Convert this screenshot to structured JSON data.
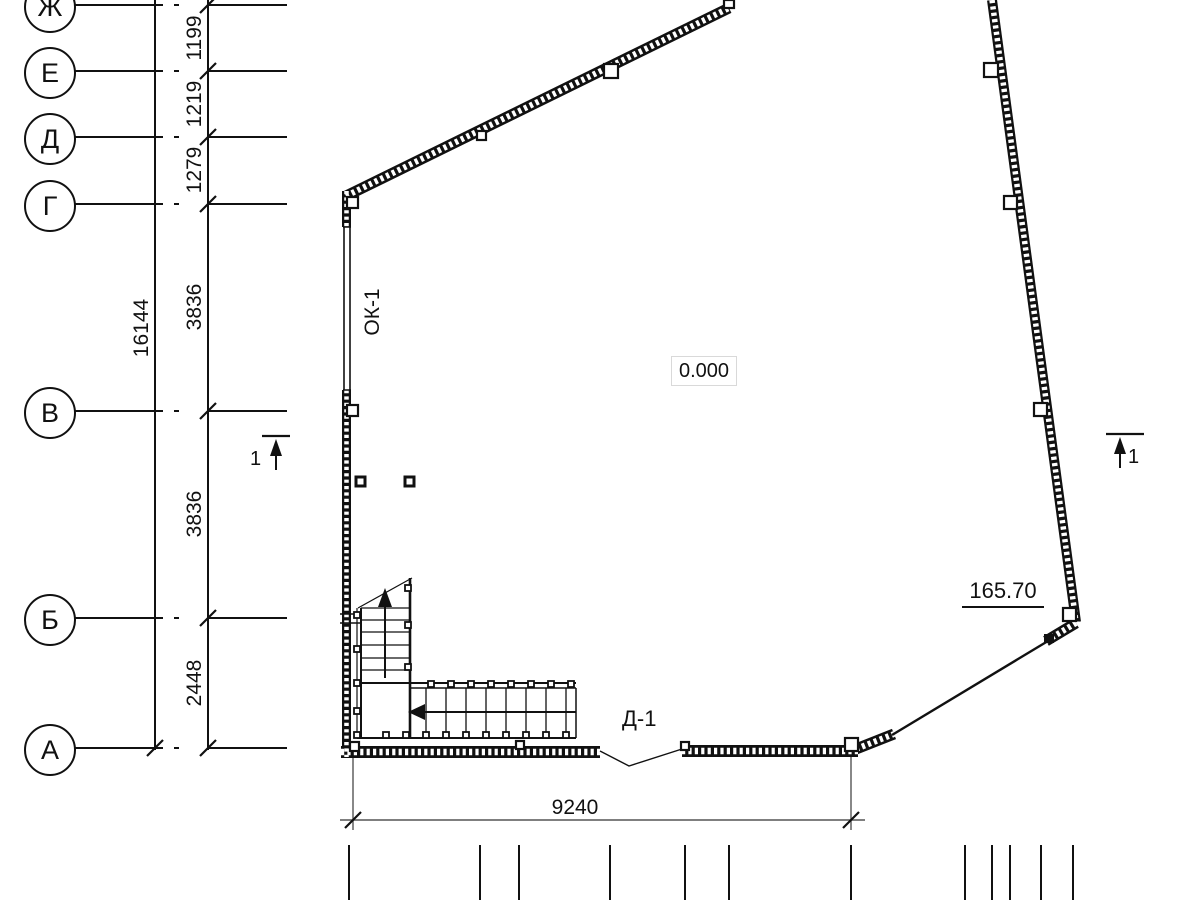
{
  "drawing": {
    "axis_labels": [
      "Ж",
      "Е",
      "Д",
      "Г",
      "В",
      "Б",
      "А"
    ],
    "vertical_dims": [
      "1199",
      "1219",
      "1279",
      "3836",
      "3836",
      "2448"
    ],
    "overall_height_dim": "16144",
    "overall_width_dim": "9240",
    "window_label": "ОК-1",
    "level_mark": "0.000",
    "door_label": "Д-1",
    "elevation_mark": "165.70",
    "section_marks": [
      "1",
      "1"
    ],
    "colors": {
      "line": "#111111",
      "background": "#ffffff",
      "level_box_border": "#d9d9d9"
    }
  }
}
